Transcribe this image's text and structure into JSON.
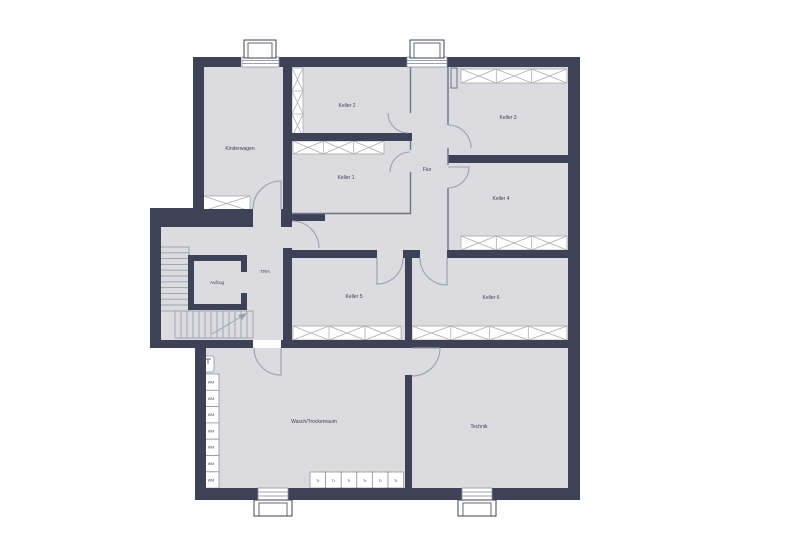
{
  "plan": {
    "type": "basement-floor-plan",
    "rooms": {
      "kinderwagen": "Kinderwagen",
      "keller1": "Keller 1",
      "keller2": "Keller 2",
      "keller3": "Keller 3",
      "keller4": "Keller 4",
      "keller5": "Keller 5",
      "keller6": "Keller 6",
      "flur": "Flur",
      "trh": "TRH",
      "aufzug": "Aufzug",
      "wasch": "Wasch/Trockenraum",
      "technik": "Technik"
    },
    "appliances": {
      "washing_machine_label": "WM",
      "washing_machine_count": 7,
      "dryer_label": "Tr",
      "dryer_count": 6
    },
    "colors": {
      "wall": "#3e4256",
      "floor": "#dbdbe0",
      "partition_line": "#6e7488",
      "door_arc": "#9aa0b0",
      "hatch_line": "#a9aeab",
      "text": "#3c4152",
      "background": "#ffffff"
    }
  }
}
